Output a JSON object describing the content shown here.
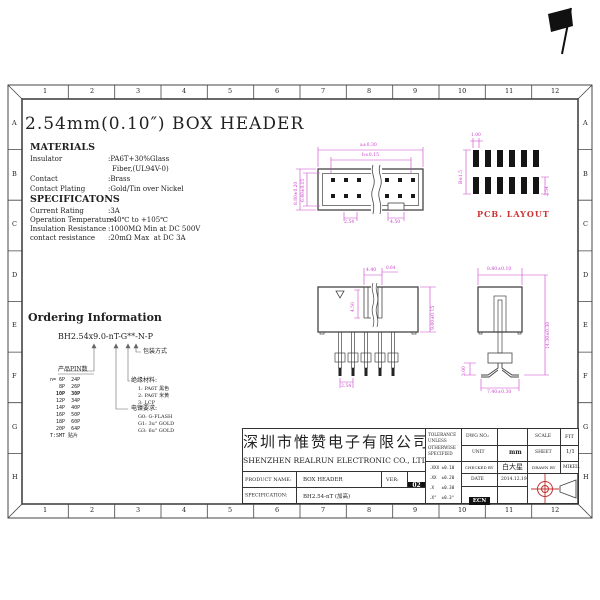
{
  "page_title": "2.54mm(0.10″) BOX HEADER",
  "materials": {
    "heading": "MATERIALS",
    "rows": [
      {
        "label": "Insulator",
        "value": ":PA6T+30%Glass"
      },
      {
        "label": "",
        "value": "Fiber,(UL94V-0)"
      },
      {
        "label": "Contact",
        "value": ":Brass"
      },
      {
        "label": "Contact Plating",
        "value": ":Gold/Tin over Nickel"
      }
    ]
  },
  "specifications": {
    "heading": "SPECIFICATONS",
    "rows": [
      {
        "label": "Current Rating",
        "value": ":3A"
      },
      {
        "label": "Operation Temperature",
        "value": ":-40℃ to +105℃"
      },
      {
        "label": "Insulation Resistance",
        "value": ":1000MΩ Min at DC 500V"
      },
      {
        "label": "contact resistance",
        "value": ":20mΩ Max  at DC 3A"
      }
    ]
  },
  "ordering": {
    "heading": "Ordering Information",
    "part_number": "BH2.54x9.0-nT-G**-N-P",
    "packaging_label": "包装方式",
    "pin_count": {
      "heading": "产品PIN数",
      "rows": [
        "n= 6P  24P",
        "   8P  26P",
        "  10P  30P",
        "  12P  34P",
        "  14P  40P",
        "  16P  50P",
        "  18P  60P",
        "  20P  64P",
        "T:SMT 贴片"
      ]
    },
    "material": {
      "heading": "绝缘材料:",
      "items": [
        "1: PA6T 黑色",
        "2: PA6T 米黄",
        "3: LCP"
      ]
    },
    "plating": {
      "heading": "电镍要求:",
      "items": [
        "G0: G-FLASH",
        "G1: 3u\" GOLD",
        "G3: 6u\" GOLD"
      ]
    }
  },
  "drawings": {
    "top_view": {
      "dim_outer": "a±0.30",
      "dim_inner": "b±0.15",
      "dim_left_outer": "8.80±0.20",
      "dim_left_inner": "6.40±0.15",
      "dim_pitch": "2.54",
      "dim_notch": "4.50"
    },
    "pcb_layout": {
      "label": "PCB. LAYOUT",
      "dim_pad": "1.00",
      "dim_row": "B±1.5",
      "dim_pitch": "2.54"
    },
    "front_view": {
      "dim_slot": "4.40",
      "dim_pin": "0.64",
      "dim_depth": "4.50",
      "dim_height": "9.00±0.15",
      "dim_pitch": "2.54"
    },
    "side_view": {
      "dim_width": "8.80±0.10",
      "dim_total": "14.30±0.30",
      "dim_standoff": "3.00",
      "dim_foot": "7.40±0.30"
    }
  },
  "title_block": {
    "company_cn": "深圳市惟赞电子有限公司",
    "company_en": "SHENZHEN REALRUN ELECTRONIC CO., LTD.",
    "product_name_label": "PRODUCT NAME:",
    "product_name": "BOX HEADER",
    "ver_label": "VER:",
    "ver": "02",
    "spec_label": "SPECIFICATION:",
    "spec": "BH2.54-nT (加高)",
    "tolerance_title": "TOLERANCE UNLESS OTHERWISE SPECIFIED",
    "tolerances": [
      ".XXX ±0.10",
      ".XX  ±0.20",
      ".X   ±0.30",
      ".X°  ±0.3°"
    ],
    "dwg_no_label": "DWG NO.:",
    "scale_label": "SCALE",
    "scale": "FIT",
    "unit_label": "UNIT",
    "unit": "mm",
    "sheet_label": "SHEET",
    "sheet": "1/1",
    "checked_label": "CHECKED BY",
    "checked": "白大星",
    "drawn_label": "DRAWN BY",
    "drawn": "MIKEL.",
    "date_label": "DATE",
    "date": "2014.12.19",
    "ecn": "ECN"
  },
  "frame": {
    "cols": [
      "1",
      "2",
      "3",
      "4",
      "5",
      "6",
      "7",
      "8",
      "9",
      "10",
      "11",
      "12"
    ],
    "rows": [
      "A",
      "B",
      "C",
      "D",
      "E",
      "F",
      "G",
      "H"
    ]
  },
  "colors": {
    "dimension": "#cc44cc",
    "accent_red": "#cc3333",
    "line": "#444444"
  }
}
